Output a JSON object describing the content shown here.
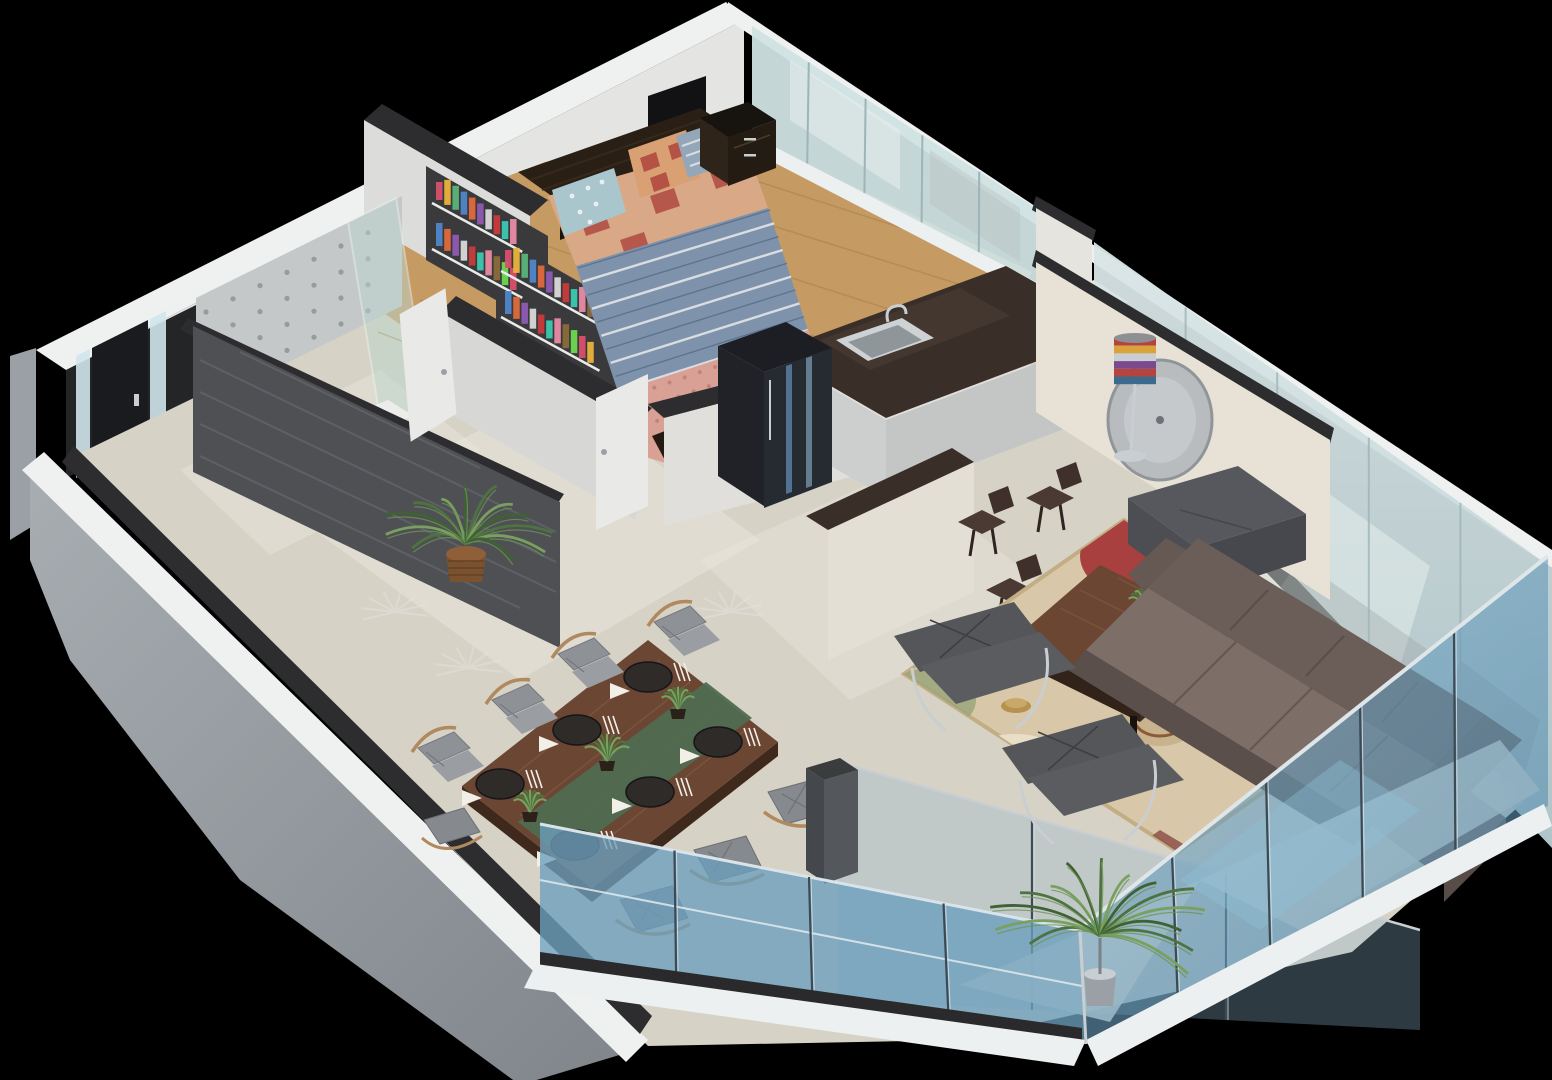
{
  "title": "3d-apartment-cutaway-floor-plan",
  "palette": {
    "background": "#000000",
    "wall_ridge": "#eff1f1",
    "wall_face_white": "#e4e4e2",
    "wall_face_shadow": "#c9c9c6",
    "wall_top_charcoal": "#2d2d30",
    "wall_dark_entry": "#232527",
    "exterior_gray": "#9aa0a5",
    "exterior_gray_dark": "#82878c",
    "floor_tile": "#d7d2c6",
    "floor_tile_light": "#eae6dc",
    "floor_wood": "#c59a63",
    "wood_plank_line": "#ad8450",
    "glass_pale": "#cfe2e2",
    "glass_mullion": "#9fb4b8",
    "glass_reflection": "#e8f1ee",
    "glass_blue_outer": "#6b9fbd",
    "glass_blue_deep": "#4f86a8",
    "glass_blue_light": "#8fc0d8",
    "rail_white": "#ecf0f1",
    "chrome": "#c9ced2",
    "counter_dark": "#3a2f28",
    "cabinet_light": "#cdcfcf",
    "sink_steel": "#ced2d4",
    "sink_basin": "#8e969a",
    "cooktop_white": "#e8e9e7",
    "oven_dark": "#2b2e31",
    "fridge_black": "#1c1e24",
    "fridge_face": "#262a31",
    "fridge_glow": "#5b7fa6",
    "bar_cream": "#e4dfd4",
    "clockwall_cream": "#e8e2d6",
    "clock_gray": "#b9bcbe",
    "stool_brown": "#4a3a33",
    "sofa_taupe": "#6b5d58",
    "sofa_seat": "#7d6e67",
    "sofa_dark": "#5a4f4a",
    "ottoman_gray": "#56585d",
    "lounge_gray": "#54565a",
    "rug_base": "#d8c8a9",
    "rug_border": "#c2ad84",
    "rug_red": "#a8403f",
    "rug_brown": "#8a5a38",
    "rug_tan": "#c9b28e",
    "rug_cream": "#e9dfc8",
    "table_walnut": "#6b4733",
    "table_edge": "#3f291c",
    "runner_green": "#4f6b51",
    "plate_dark": "#2e2b29",
    "napkin_white": "#f2efe8",
    "chair_cushion": "#8e9196",
    "chair_wood": "#b08a5e",
    "bed_frame": "#241a12",
    "headboard": "#2a1f15",
    "duvet_blue": "#7e93ab",
    "duvet_stripe": "#d9dde2",
    "duvet_stripe_dark": "#5d7490",
    "patch_tan": "#d9a887",
    "patch_red": "#b04a42",
    "throw_pink": "#d9a195",
    "pillow_blue": "#aac6cd",
    "pillow_tan": "#d9a073",
    "pillow_stripe": "#93a7b8",
    "slate_dark": "#4e5054",
    "slate_streak": "#65686d",
    "concrete": "#c5c8c9",
    "concrete_dot": "#969b9e",
    "shower_glass": "#bcd6cd",
    "plant_green": "#4e7340",
    "plant_light": "#79a05e",
    "pot_wicker": "#7a5230",
    "pot_gray": "#9aa0a5",
    "door_white": "#e9e9e7",
    "door_dark": "#1a1b1e",
    "lamp_gold": "#b5924e",
    "niche_dark": "#3a3a3c"
  },
  "scene": {
    "books": {
      "colors": [
        "#d94f6e",
        "#e9b23a",
        "#5bb47a",
        "#4f86c9",
        "#e06a3b",
        "#8e5bb4",
        "#d9d9d9",
        "#c93a3a",
        "#3ac9b0",
        "#e88aa5",
        "#8a6b3a",
        "#6bd94f"
      ],
      "cases": [
        {
          "x": 436,
          "y": 200,
          "rows": 2,
          "cols": 10
        },
        {
          "x": 505,
          "y": 268,
          "rows": 2,
          "cols": 11
        }
      ]
    },
    "lamp_stripes": [
      "#b5443e",
      "#d9a23a",
      "#c9ced2",
      "#7a4a8e",
      "#b5443e",
      "#3a6b8e"
    ],
    "dining": {
      "plates": [
        [
          648,
          677
        ],
        [
          577,
          730
        ],
        [
          500,
          784
        ],
        [
          575,
          845
        ],
        [
          650,
          792
        ],
        [
          718,
          742
        ]
      ],
      "chairs": [
        {
          "x": 592,
          "y": 654,
          "side": "nw"
        },
        {
          "x": 526,
          "y": 700,
          "side": "nw"
        },
        {
          "x": 452,
          "y": 748,
          "side": "nw"
        },
        {
          "x": 688,
          "y": 622,
          "side": "nw"
        },
        {
          "x": 648,
          "y": 906,
          "side": "se"
        },
        {
          "x": 722,
          "y": 856,
          "side": "se"
        },
        {
          "x": 796,
          "y": 798,
          "side": "se"
        },
        {
          "x": 452,
          "y": 838,
          "side": "w"
        }
      ],
      "table_plants": [
        [
          678,
          703
        ],
        [
          607,
          755
        ],
        [
          530,
          806
        ]
      ]
    },
    "kitchen": {
      "stools": [
        [
          982,
          522
        ],
        [
          1050,
          498
        ],
        [
          1010,
          590
        ]
      ],
      "burners": [
        [
          1062,
          298
        ],
        [
          1084,
          290
        ],
        [
          1078,
          312
        ],
        [
          1100,
          304
        ]
      ]
    },
    "palms": [
      {
        "x": 466,
        "y": 536,
        "r": 88,
        "n": 12,
        "pot": "wicker"
      },
      {
        "x": 1100,
        "y": 928,
        "r": 115,
        "n": 14,
        "pot": "gray"
      }
    ],
    "ghost_palms": [
      [
        395,
        612
      ],
      [
        468,
        668
      ],
      [
        730,
        612
      ]
    ],
    "balcony": {
      "right_posts": 5,
      "left_posts": 4,
      "run2_posts": 3
    },
    "glass": {
      "bedroom_mullions": 4,
      "living_mullions": 4
    },
    "bed": {
      "stripes": 10
    },
    "concrete_dots": {
      "rows": 4,
      "cols": 7
    }
  }
}
